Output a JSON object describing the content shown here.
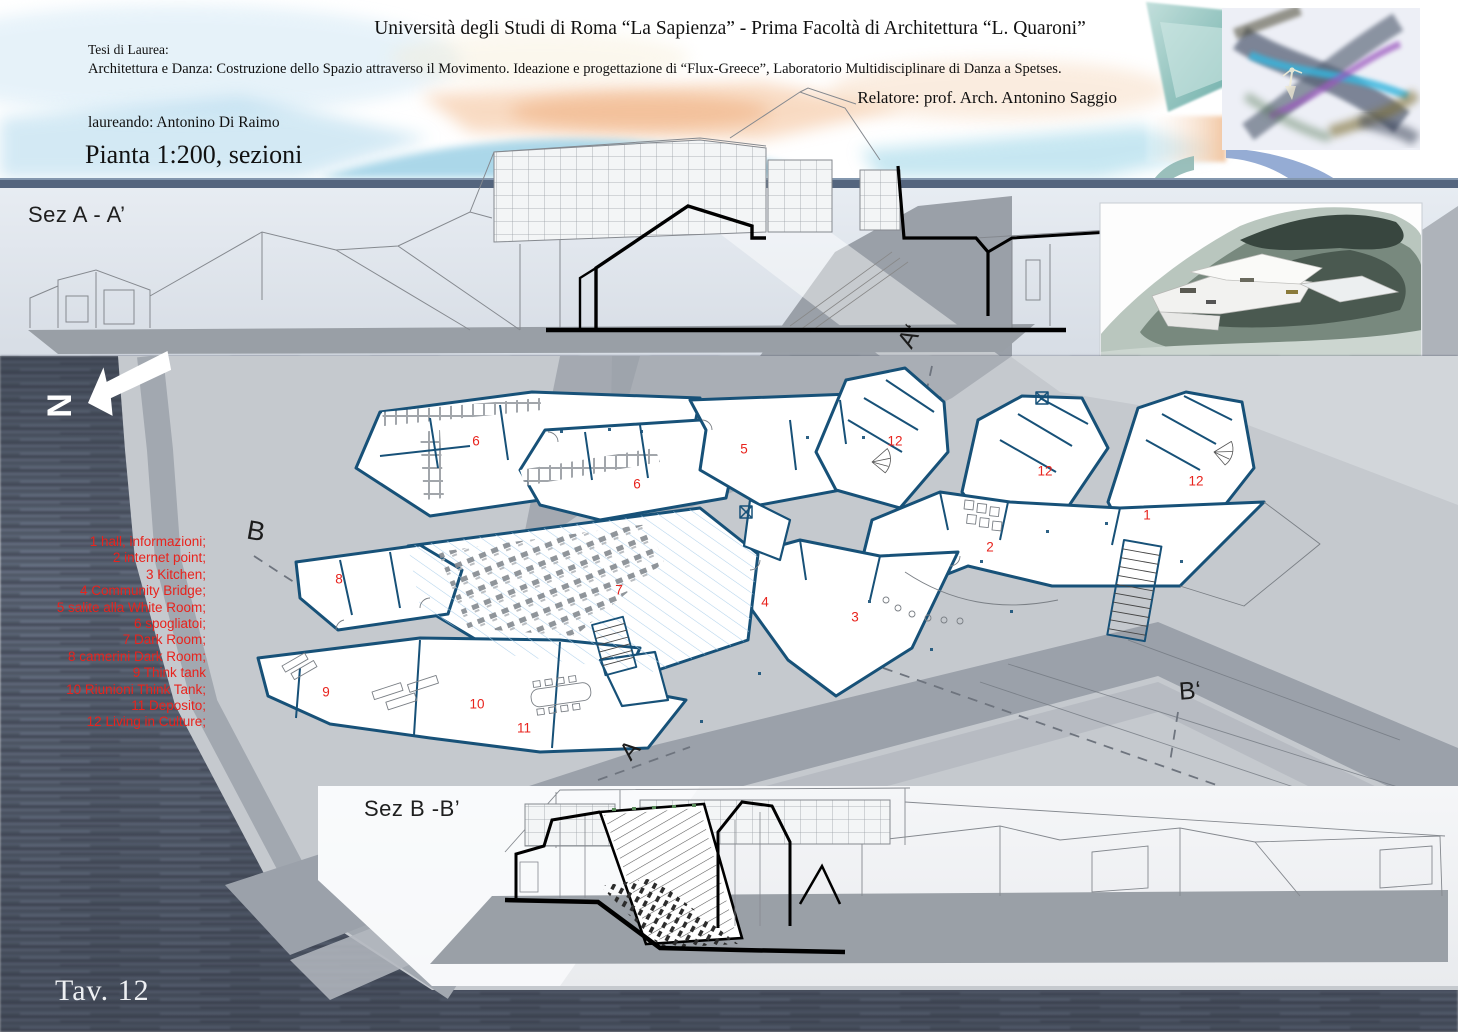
{
  "header": {
    "university_title": "Università degli Studi di Roma “La Sapienza” -  Prima Facoltà di Architettura “L. Quaroni”",
    "thesis_label": "Tesi di Laurea:",
    "thesis_line": "Architettura e Danza: Costruzione dello Spazio attraverso il Movimento. Ideazione e progettazione di “Flux-Greece”, Laboratorio Multidisciplinare di Danza a Spetses.",
    "advisor": "Relatore: prof. Arch. Antonino Saggio",
    "student": "laureando: Antonino Di Raimo",
    "sheet_title": "Pianta 1:200, sezioni"
  },
  "sections": {
    "a_label": "Sez A - A’",
    "b_label": "Sez B -B’"
  },
  "plan": {
    "north_label": "N",
    "markers": {
      "a": "A",
      "a_prime": "A‘",
      "b": "B",
      "b_prime": "B‘"
    },
    "room_numbers": [
      {
        "n": "6",
        "x": 476,
        "y": 441
      },
      {
        "n": "5",
        "x": 744,
        "y": 449
      },
      {
        "n": "12",
        "x": 895,
        "y": 441
      },
      {
        "n": "6",
        "x": 637,
        "y": 484
      },
      {
        "n": "12",
        "x": 1045,
        "y": 471
      },
      {
        "n": "12",
        "x": 1196,
        "y": 481
      },
      {
        "n": "1",
        "x": 1147,
        "y": 515
      },
      {
        "n": "2",
        "x": 990,
        "y": 547
      },
      {
        "n": "8",
        "x": 339,
        "y": 579
      },
      {
        "n": "7",
        "x": 619,
        "y": 590
      },
      {
        "n": "4",
        "x": 765,
        "y": 602
      },
      {
        "n": "3",
        "x": 855,
        "y": 617
      },
      {
        "n": "9",
        "x": 326,
        "y": 692
      },
      {
        "n": "10",
        "x": 477,
        "y": 704
      },
      {
        "n": "11",
        "x": 524,
        "y": 728
      }
    ]
  },
  "legend": {
    "items": [
      "1 hall, informazioni;",
      "2 internet point;",
      "3 Kitchen;",
      "4 Community Bridge;",
      "5 salite alla White Room;",
      "6 spogliatoi;",
      "7 Dark Room;",
      "8 camerini Dark Room;",
      "9 Think tank",
      "10 Riunioni Think Tank;",
      "11 Deposito;",
      "12 Living in Culture;"
    ]
  },
  "footer": {
    "sheet_number": "Tav. 12"
  },
  "colors": {
    "wall_navy": "#175178",
    "label_red": "#e8231d",
    "water": "#535b6b",
    "land_light": "#c5c9ce",
    "land_mid": "#a2a8b0",
    "band_bar": "#54657e"
  }
}
